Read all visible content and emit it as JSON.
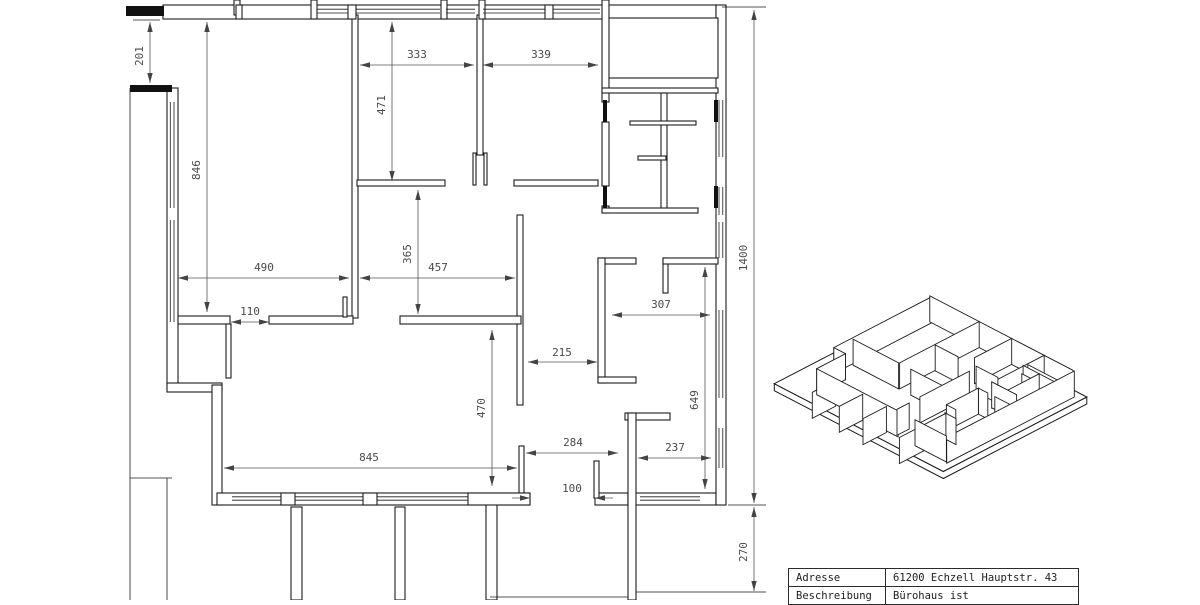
{
  "drawing": {
    "dims": {
      "left_offset": "201",
      "upper_left_room_height": "846",
      "room_a_width": "333",
      "room_a_height": "471",
      "room_b_width": "339",
      "upper_left_room_width": "490",
      "door_opening": "110",
      "corridor_depth": "365",
      "corridor_width": "457",
      "hall_opening": "215",
      "hall_width": "307",
      "right_room_height": "649",
      "lower_room_height": "470",
      "lower_room_width": "845",
      "lower_mid_width": "284",
      "lower_right_width": "237",
      "passage_width": "100",
      "total_height": "1400",
      "terrace_depth": "270"
    }
  },
  "title_block": {
    "rows": [
      {
        "label": "Adresse",
        "value": "61200 Echzell Hauptstr. 43"
      },
      {
        "label": "Beschreibung",
        "value": "Bürohaus ist"
      }
    ]
  }
}
